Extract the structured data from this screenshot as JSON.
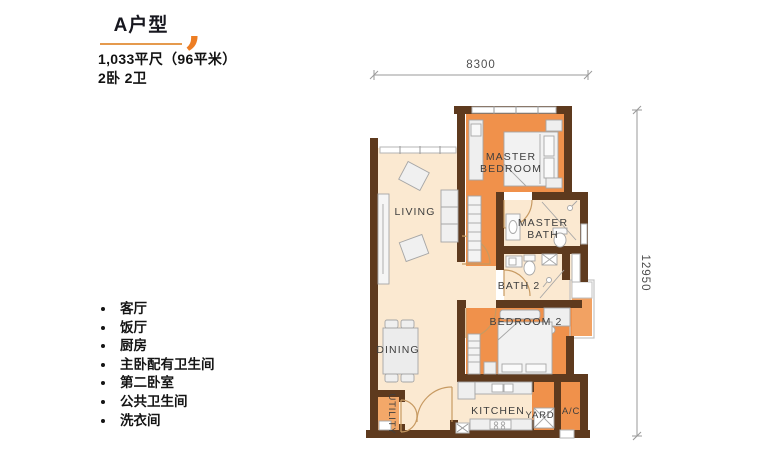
{
  "header": {
    "title": "A户型",
    "quote_mark": ",",
    "area": "1,033平尺（96平米）",
    "rooms_summary": "2卧 2卫"
  },
  "features": {
    "items": [
      "客厅",
      "饭厅",
      "厨房",
      "主卧配有卫生间",
      "第二卧室",
      "公共卫生间",
      "洗衣间"
    ]
  },
  "plan": {
    "labels": {
      "living": "LIVING",
      "master_bedroom1": "MASTER",
      "master_bedroom2": "BEDROOM",
      "master_bath1": "MASTER",
      "master_bath2": "BATH",
      "bath2": "BATH 2",
      "bedroom2": "BEDROOM 2",
      "dining": "DINING",
      "kitchen": "KITCHEN",
      "yard": "YARD",
      "ac": "A/C",
      "utility": "UTILITY"
    },
    "dimensions": {
      "width": "8300",
      "height": "12950"
    },
    "colors": {
      "room_orange": "#F0914B",
      "room_cream": "#FBE9D1",
      "wall_brown": "#5E3A1E",
      "accent_orange": "#ED7D23"
    }
  }
}
